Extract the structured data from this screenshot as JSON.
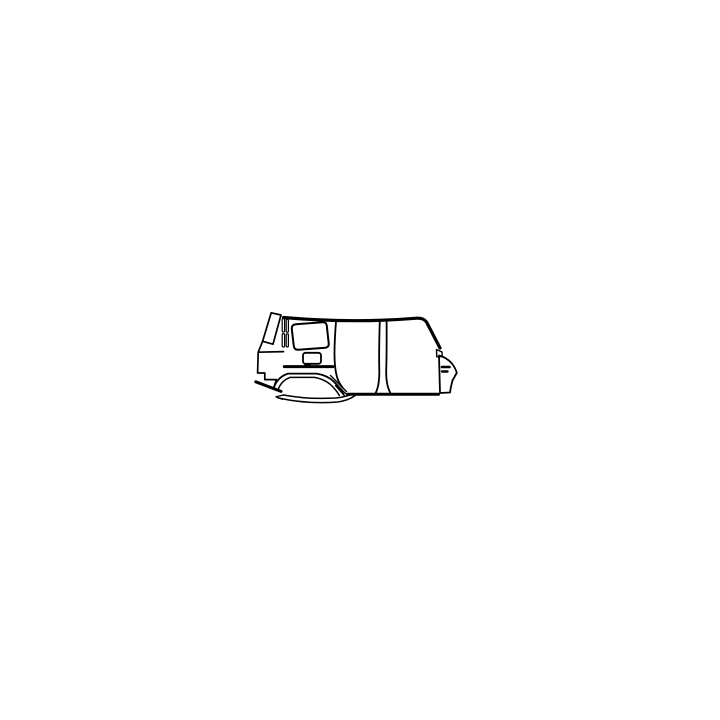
{
  "illustration": {
    "description": "Black line drawing of an SUV body side panel (rear quarter panel, sliding door, B-pillar and front door area), side view, on a plain white background",
    "line_color": "#000000",
    "background_color": "#ffffff",
    "canvas": {
      "width": 720,
      "height": 720
    },
    "paths": [
      {
        "name": "roof-and-a-pillar-line",
        "d": "M283.5 317.5 Q352 323.5 417 318.2 Q423.5 317.8 426.5 322 L440 348",
        "w": 3.2
      },
      {
        "name": "quarter-vent-triangle",
        "d": "M436.5 349.5 L442 352 L442.2 356.5 L436.8 356.8 Z",
        "w": 1.4
      },
      {
        "name": "front-fender-outline",
        "d": "M439 355.5 Q446.5 357.5 451.5 363 Q455.5 368 456.8 372.8 L452.5 380.5 Q450.8 386.5 450 392.5 L440 393 L439 355.5 Z",
        "w": 1.8
      },
      {
        "name": "fender-dash-upper",
        "d": "M442 367 L449.5 367",
        "w": 2.6
      },
      {
        "name": "fender-dash-lower",
        "d": "M442 371.5 L447.5 371.5",
        "w": 2.4
      },
      {
        "name": "rocker-sill-line",
        "d": "M347.5 394.2 L438.5 394.2",
        "w": 3
      },
      {
        "name": "b-pillar-left-line",
        "d": "M379.8 320.5 Q378.8 352 379.3 371 Q379.5 385 375.8 392.8",
        "w": 1.8
      },
      {
        "name": "b-pillar-right-line",
        "d": "M386.6 320.5 Q386.8 352 386.2 371 Q386 385 390.3 392.8",
        "w": 1.8
      },
      {
        "name": "rear-door-gap-line",
        "d": "M336 321.5 Q334.4 342 334.5 355 Q334.6 367 336.5 375 Q338 382 342.5 387.5",
        "w": 1.8
      },
      {
        "name": "quarter-window-outline",
        "d": "M296 324.3 L322.5 322.3 Q326.3 322 326.8 325.8 L328.7 343.2 Q329.2 347.3 325.2 347.7 L298.5 349.7 Q294.3 350.1 293.8 346 L291.8 329.2 Q291.3 324.7 296 324.3 Z",
        "w": 2
      },
      {
        "name": "d-pillar-outline",
        "d": "M271.2 312.8 L281 315 L273 344.2 L262.6 341.3 Z",
        "w": 1.7
      },
      {
        "name": "channel-strip-upper-left",
        "type": "rect",
        "x": 282.2,
        "y": 318.6,
        "rw": 2.4,
        "rh": 13.4,
        "rx": 1.1,
        "w": 1.2
      },
      {
        "name": "channel-strip-lower-left",
        "type": "rect",
        "x": 282.2,
        "y": 333.6,
        "rw": 2.4,
        "rh": 13.4,
        "rx": 1.1,
        "w": 1.2
      },
      {
        "name": "channel-strip-upper-right",
        "type": "rect",
        "x": 286.2,
        "y": 319.3,
        "rw": 2.2,
        "rh": 13,
        "rx": 1,
        "w": 1.2
      },
      {
        "name": "channel-strip-lower-right",
        "type": "rect",
        "x": 286.2,
        "y": 333.9,
        "rw": 2.2,
        "rh": 13,
        "rx": 1,
        "w": 1.2
      },
      {
        "name": "rear-lower-step-outline",
        "d": "M262.6 341.3 L258.2 352.2 L283.5 351.6 M258.2 352.2 L257.6 373 L264.8 373 L264.8 379.6 L276.4 379.6 L273.6 388.4",
        "w": 1.7
      },
      {
        "name": "rocker-stroke",
        "d": "M255.8 381.8 L281 391.4",
        "w": 3
      },
      {
        "name": "wheel-arch-outer",
        "d": "M273.6 388.4 Q277 377.2 288 373.6 L316.5 373.6 Q327.5 375.2 334.5 382.2 Q340.5 388.2 343.5 394.4",
        "w": 1.8
      },
      {
        "name": "wheel-arch-inner",
        "d": "M277.6 390.8 Q281 380.6 290 377.4 L314.5 377.4 Q324.5 379.2 331 385 Q336.5 390.4 339.3 395.4",
        "w": 1.5
      },
      {
        "name": "arch-lip-upper",
        "d": "M283.5 395 Q308 399.6 335.5 398 Q346.5 397 352.5 393.6",
        "w": 1.5
      },
      {
        "name": "arch-lip-lower",
        "d": "M278.4 398 Q308 404.4 337.5 402 Q348.5 400.4 355 395.6",
        "w": 1.5
      },
      {
        "name": "arch-lip-fold",
        "d": "M283.5 395 L276 396.8 L282.4 399.3 M276 396.8 L278.4 398",
        "w": 1.3
      },
      {
        "name": "arch-door-hatch-lines",
        "d": "M330.5 375.5 L346.5 391.5 M332.5 380.5 L345.5 393.5 M335.5 385.5 L344.6 395.8",
        "w": 1.4
      },
      {
        "name": "fuel-door-outline",
        "type": "rect",
        "x": 303,
        "y": 352.8,
        "rw": 18,
        "rh": 11,
        "rx": 2.6,
        "w": 1.8
      },
      {
        "name": "fuel-door-hinge",
        "type": "rect",
        "x": 304.6,
        "y": 363.6,
        "rw": 5.6,
        "rh": 3.4,
        "rx": 0.5,
        "w": 0.8,
        "fill": "line"
      },
      {
        "name": "body-crease-line",
        "d": "M284.3 366.6 L333 366.6",
        "w": 3
      }
    ]
  }
}
